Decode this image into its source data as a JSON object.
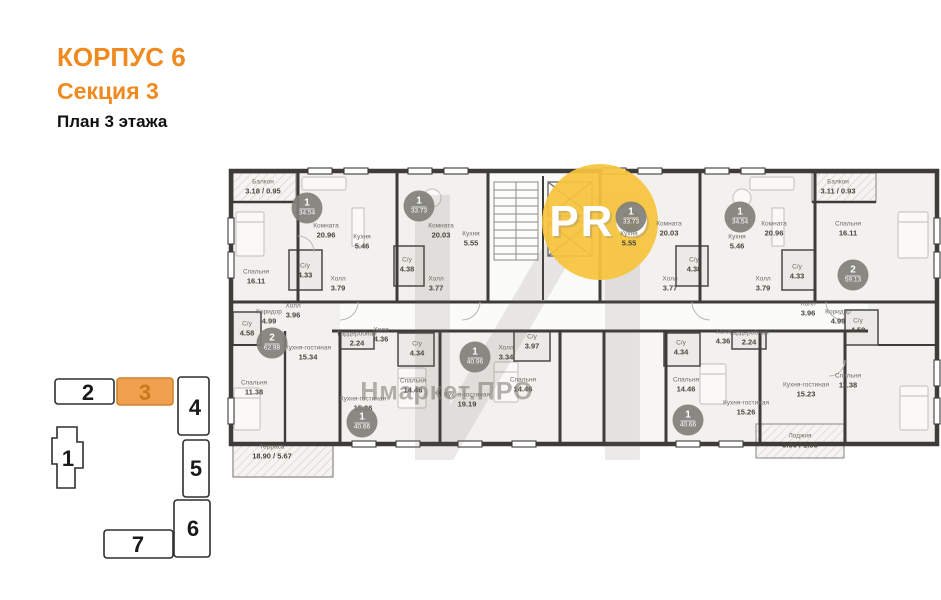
{
  "colors": {
    "accent_orange": "#EE8A1F",
    "keyplan_highlight": "#F0A14F",
    "watermark_yellow": "#F6C43C",
    "wall": "#3E3C39"
  },
  "header": {
    "building": "КОРПУС 6",
    "section_label": "Секция 3",
    "floor_label": "План 3 этажа"
  },
  "key_plan": {
    "highlighted": "3",
    "sections": [
      "1",
      "2",
      "3",
      "4",
      "5",
      "6",
      "7"
    ]
  },
  "watermark": {
    "logo_text": "PRO",
    "brand_text": "Нмаркет.ПРО"
  },
  "plan": {
    "badges": [
      {
        "number": "2",
        "area": "62.98",
        "x": 272,
        "y": 343
      },
      {
        "number": "1",
        "area": "34.54",
        "x": 307,
        "y": 208
      },
      {
        "number": "1",
        "area": "33.73",
        "x": 419,
        "y": 206
      },
      {
        "number": "1",
        "area": "33.73",
        "x": 631,
        "y": 217
      },
      {
        "number": "1",
        "area": "34.54",
        "x": 740,
        "y": 217
      },
      {
        "number": "2",
        "area": "59.13",
        "x": 853,
        "y": 275
      },
      {
        "number": "1",
        "area": "40.66",
        "x": 362,
        "y": 422
      },
      {
        "number": "1",
        "area": "40.96",
        "x": 475,
        "y": 357
      },
      {
        "number": "1",
        "area": "40.66",
        "x": 688,
        "y": 420
      }
    ],
    "rooms": [
      {
        "name": "Балкон",
        "area": "3.18 / 0.95",
        "x": 263,
        "y": 187
      },
      {
        "name": "Спальня",
        "area": "16.11",
        "x": 256,
        "y": 277
      },
      {
        "name": "Коридор",
        "area": "4.99",
        "x": 269,
        "y": 317
      },
      {
        "name": "С/у",
        "area": "4.58",
        "x": 247,
        "y": 329
      },
      {
        "name": "Спальня",
        "area": "11.38",
        "x": 254,
        "y": 388
      },
      {
        "name": "Кухня-гостиная",
        "area": "15.34",
        "x": 308,
        "y": 353
      },
      {
        "name": "Холл",
        "area": "3.96",
        "x": 293,
        "y": 311
      },
      {
        "name": "Терраса",
        "area": "18.90 / 5.67",
        "x": 272,
        "y": 452
      },
      {
        "name": "Комната",
        "area": "20.96",
        "x": 326,
        "y": 231
      },
      {
        "name": "Кухня",
        "area": "5.46",
        "x": 362,
        "y": 242
      },
      {
        "name": "С/у",
        "area": "4.33",
        "x": 305,
        "y": 271
      },
      {
        "name": "Холл",
        "area": "3.79",
        "x": 338,
        "y": 284
      },
      {
        "name": "Комната",
        "area": "20.03",
        "x": 441,
        "y": 231
      },
      {
        "name": "Кухня",
        "area": "5.55",
        "x": 471,
        "y": 239
      },
      {
        "name": "С/у",
        "area": "4.38",
        "x": 407,
        "y": 265
      },
      {
        "name": "Холл",
        "area": "3.77",
        "x": 436,
        "y": 284
      },
      {
        "name": "Кухня",
        "area": "5.55",
        "x": 629,
        "y": 239
      },
      {
        "name": "Комната",
        "area": "20.03",
        "x": 669,
        "y": 229
      },
      {
        "name": "С/у",
        "area": "4.38",
        "x": 694,
        "y": 265
      },
      {
        "name": "Холл",
        "area": "3.77",
        "x": 670,
        "y": 284
      },
      {
        "name": "Комната",
        "area": "20.96",
        "x": 774,
        "y": 229
      },
      {
        "name": "Кухня",
        "area": "5.46",
        "x": 737,
        "y": 242
      },
      {
        "name": "С/у",
        "area": "4.33",
        "x": 797,
        "y": 272
      },
      {
        "name": "Холл",
        "area": "3.79",
        "x": 763,
        "y": 284
      },
      {
        "name": "Балкон",
        "area": "3.11 / 0.93",
        "x": 838,
        "y": 187
      },
      {
        "name": "Спальня",
        "area": "16.11",
        "x": 848,
        "y": 229
      },
      {
        "name": "Холл",
        "area": "3.96",
        "x": 808,
        "y": 309
      },
      {
        "name": "Коридор",
        "area": "4.99",
        "x": 838,
        "y": 317
      },
      {
        "name": "С/у",
        "area": "4.58",
        "x": 858,
        "y": 326
      },
      {
        "name": "Спальня",
        "area": "11.38",
        "x": 848,
        "y": 381
      },
      {
        "name": "Кухня-гостиная",
        "area": "15.23",
        "x": 806,
        "y": 390
      },
      {
        "name": "Лоджия",
        "area": "3.90 / 1.95",
        "x": 800,
        "y": 441
      },
      {
        "name": "Гардеробная",
        "area": "2.24",
        "x": 357,
        "y": 339
      },
      {
        "name": "Холл",
        "area": "4.36",
        "x": 381,
        "y": 335
      },
      {
        "name": "С/у",
        "area": "4.34",
        "x": 417,
        "y": 349
      },
      {
        "name": "Спальня",
        "area": "14.46",
        "x": 413,
        "y": 386
      },
      {
        "name": "Кухня-гостиная",
        "area": "15.26",
        "x": 363,
        "y": 404
      },
      {
        "name": "Холл",
        "area": "3.34",
        "x": 506,
        "y": 353
      },
      {
        "name": "С/у",
        "area": "3.97",
        "x": 532,
        "y": 342
      },
      {
        "name": "Спальня",
        "area": "14.46",
        "x": 523,
        "y": 385
      },
      {
        "name": "Кухня-гостиная",
        "area": "19.19",
        "x": 467,
        "y": 400
      },
      {
        "name": "С/у",
        "area": "4.34",
        "x": 681,
        "y": 348
      },
      {
        "name": "Холл",
        "area": "4.36",
        "x": 723,
        "y": 337
      },
      {
        "name": "Гардеробная",
        "area": "2.24",
        "x": 749,
        "y": 338
      },
      {
        "name": "Спальня",
        "area": "14.46",
        "x": 686,
        "y": 385
      },
      {
        "name": "Кухня-гостиная",
        "area": "15.26",
        "x": 746,
        "y": 408
      }
    ]
  }
}
